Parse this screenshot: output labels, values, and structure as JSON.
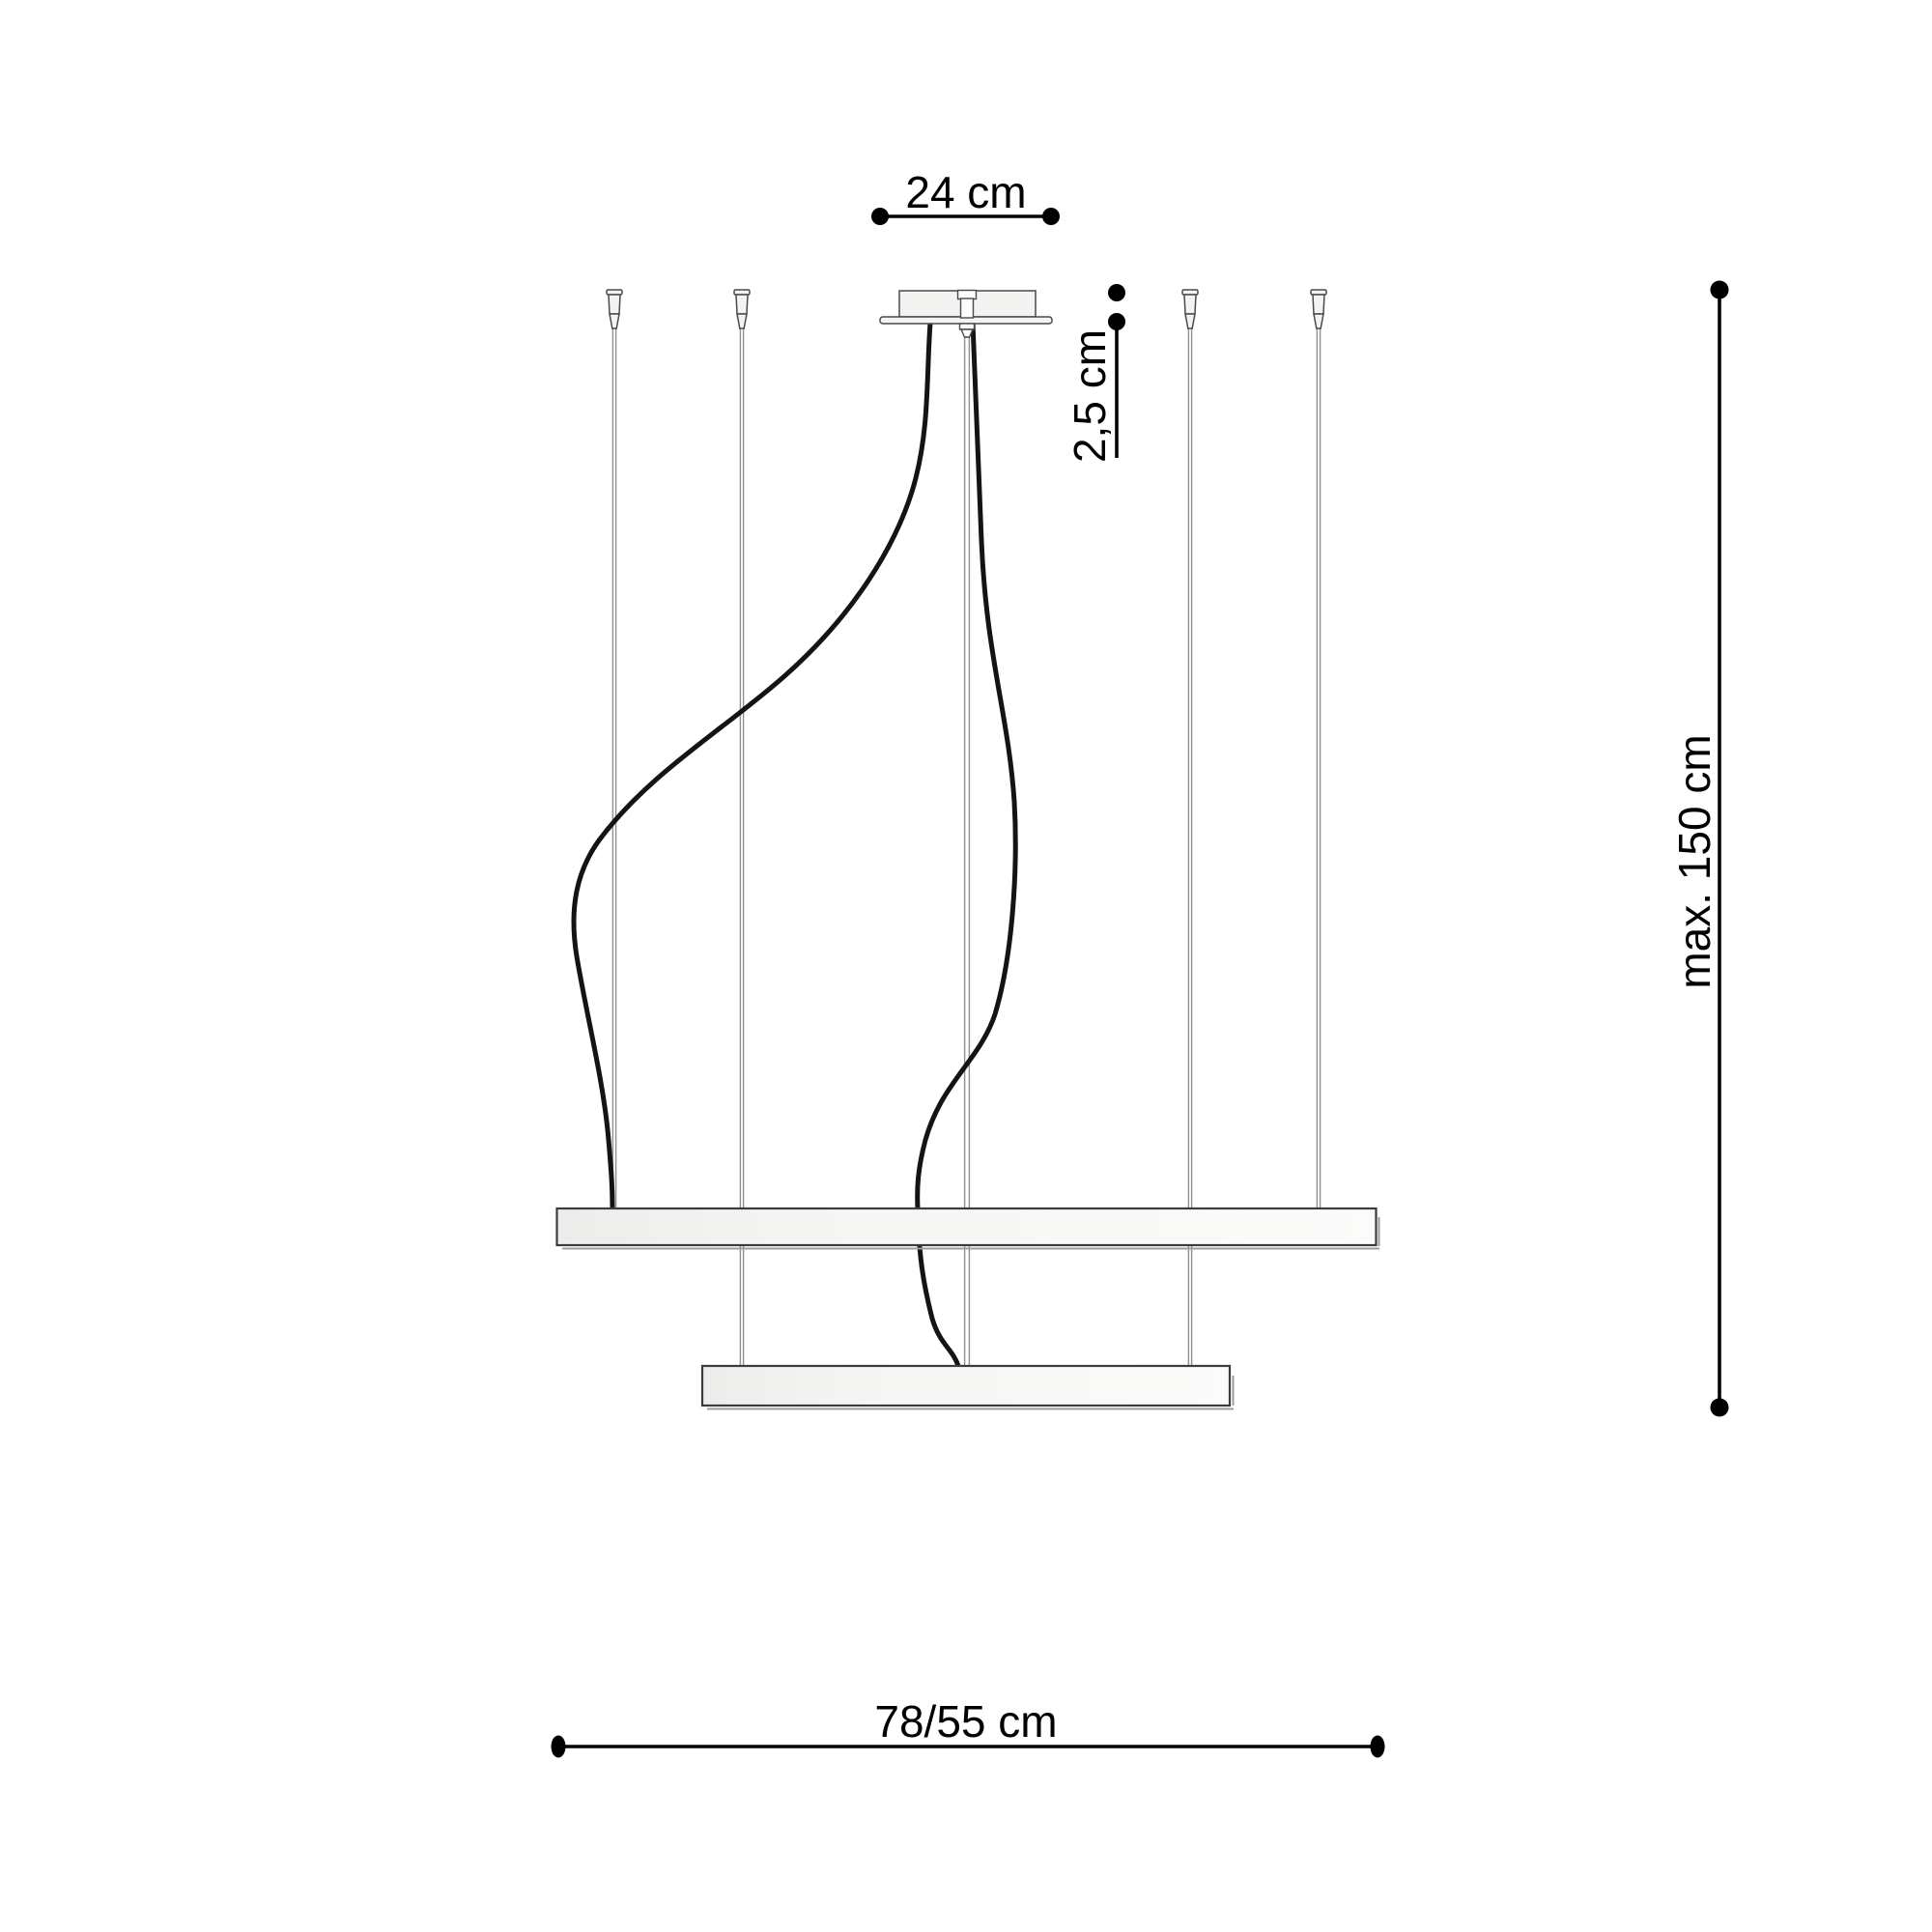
{
  "diagram": {
    "type": "technical dimension drawing",
    "subject": "two-ring pendant lamp, side view",
    "labels": {
      "canopy_width": "24 cm",
      "canopy_height": "2,5 cm",
      "suspension_max": "max. 150 cm",
      "ring_widths": "78/55 cm"
    },
    "colors": {
      "background": "#ffffff",
      "dimension_ink": "#000000",
      "outline_ink": "#4a4a4a",
      "wire_gray": "#8f8f8f",
      "cable_black": "#141414",
      "panel_fill": "#f3f3f1"
    }
  }
}
